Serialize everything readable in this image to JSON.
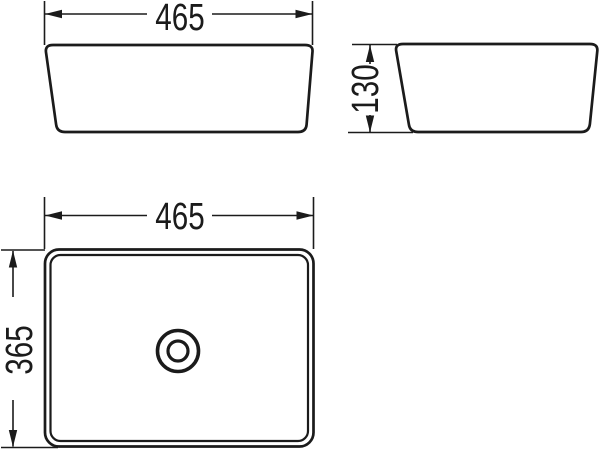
{
  "page": {
    "background": "#ffffff",
    "line_color": "#1b1b1b",
    "kind": "sink-dimension-drawing"
  },
  "views": {
    "front": {
      "width_dim": "465"
    },
    "side": {
      "height_dim": "130"
    },
    "top": {
      "width_dim": "465",
      "depth_dim": "365",
      "drain": "concentric-circles"
    }
  }
}
